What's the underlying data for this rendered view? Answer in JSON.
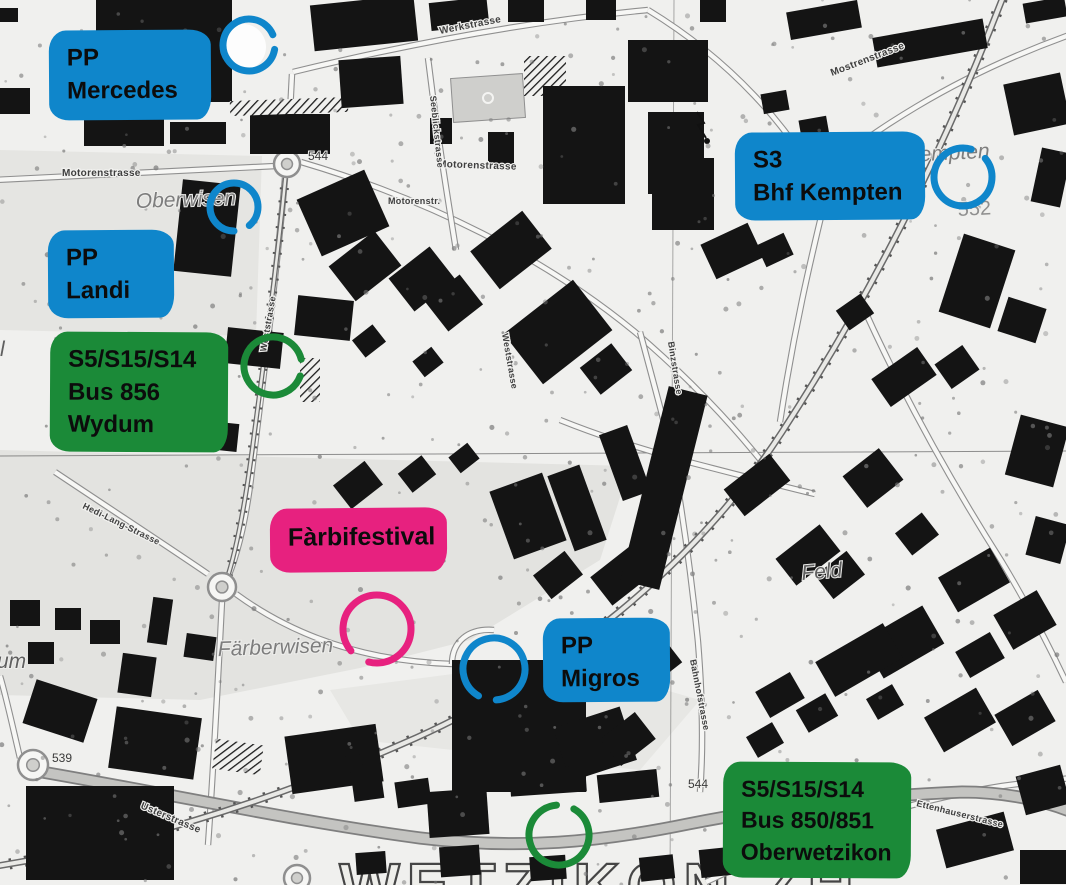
{
  "colors": {
    "annotation_blue": "#0f86cb",
    "annotation_green": "#1b8a38",
    "annotation_pink": "#e7217f"
  },
  "map": {
    "street_labels": [
      {
        "id": "werkstrasse",
        "text": "Werkstrasse"
      },
      {
        "id": "motorenstrasse_w",
        "text": "Motorenstrasse"
      },
      {
        "id": "motorenstrasse_c",
        "text": "Motorenstrasse"
      },
      {
        "id": "motorenstr_abbr",
        "text": "Motorenstr."
      },
      {
        "id": "mostrenstrasse",
        "text": "Mostrenstrasse"
      },
      {
        "id": "seeblickstrasse",
        "text": "Seeblickstrasse"
      },
      {
        "id": "weststrasse_rail",
        "text": "Weststrasse"
      },
      {
        "id": "weststrasse_c",
        "text": "Weststrasse"
      },
      {
        "id": "binzstrasse",
        "text": "Binzstrasse"
      },
      {
        "id": "hedi_lang_strasse",
        "text": "Hedi-Lang-Strasse"
      },
      {
        "id": "usterstrasse",
        "text": "Usterstrasse"
      },
      {
        "id": "bahnhofstrasse",
        "text": "Bahnhofstrasse"
      },
      {
        "id": "ettenhauserstrasse",
        "text": "Ettenhauserstrasse"
      }
    ],
    "place_labels": [
      {
        "id": "oberwisen",
        "text": "Oberwisen"
      },
      {
        "id": "kempten",
        "text": "Kempten"
      },
      {
        "id": "faerberwisen",
        "text": "Färberwisen"
      },
      {
        "id": "feld",
        "text": "Feld"
      },
      {
        "id": "fragment_um",
        "text": "um"
      },
      {
        "id": "fragment_l",
        "text": "l"
      }
    ],
    "elevations": [
      {
        "id": "e544_top",
        "text": "544"
      },
      {
        "id": "e552",
        "text": "552"
      },
      {
        "id": "e539",
        "text": "539"
      },
      {
        "id": "e544_bottom",
        "text": "544"
      }
    ],
    "city_label": "WETZIKON ZH"
  },
  "annotations": {
    "boxes": [
      {
        "id": "pp-mercedes",
        "color": "#0f86cb",
        "lines": [
          "PP",
          "Mercedes"
        ]
      },
      {
        "id": "pp-landi",
        "color": "#0f86cb",
        "lines": [
          "PP",
          "Landi"
        ]
      },
      {
        "id": "wydum-stop",
        "color": "#1b8a38",
        "lines": [
          "S5/S15/S14",
          "Bus 856",
          "Wydum"
        ]
      },
      {
        "id": "bhf-kempten",
        "color": "#0f86cb",
        "lines": [
          "S3",
          "Bhf Kempten"
        ]
      },
      {
        "id": "faerbifestival",
        "color": "#e7217f",
        "lines": [
          "Fàrbifestival"
        ]
      },
      {
        "id": "pp-migros",
        "color": "#0f86cb",
        "lines": [
          "PP",
          "Migros"
        ]
      },
      {
        "id": "oberwetzikon-stop",
        "color": "#1b8a38",
        "lines": [
          "S5/S15/S14",
          "Bus 850/851",
          "Oberwetzikon"
        ]
      }
    ],
    "circles": [
      {
        "id": "circle-mercedes",
        "color": "#0f86cb"
      },
      {
        "id": "circle-oberwisen",
        "color": "#0f86cb"
      },
      {
        "id": "circle-kempten",
        "color": "#0f86cb"
      },
      {
        "id": "circle-migros",
        "color": "#0f86cb"
      },
      {
        "id": "circle-wydum",
        "color": "#1b8a38"
      },
      {
        "id": "circle-oberwetzikon",
        "color": "#1b8a38"
      },
      {
        "id": "circle-festival",
        "color": "#e7217f"
      }
    ]
  }
}
